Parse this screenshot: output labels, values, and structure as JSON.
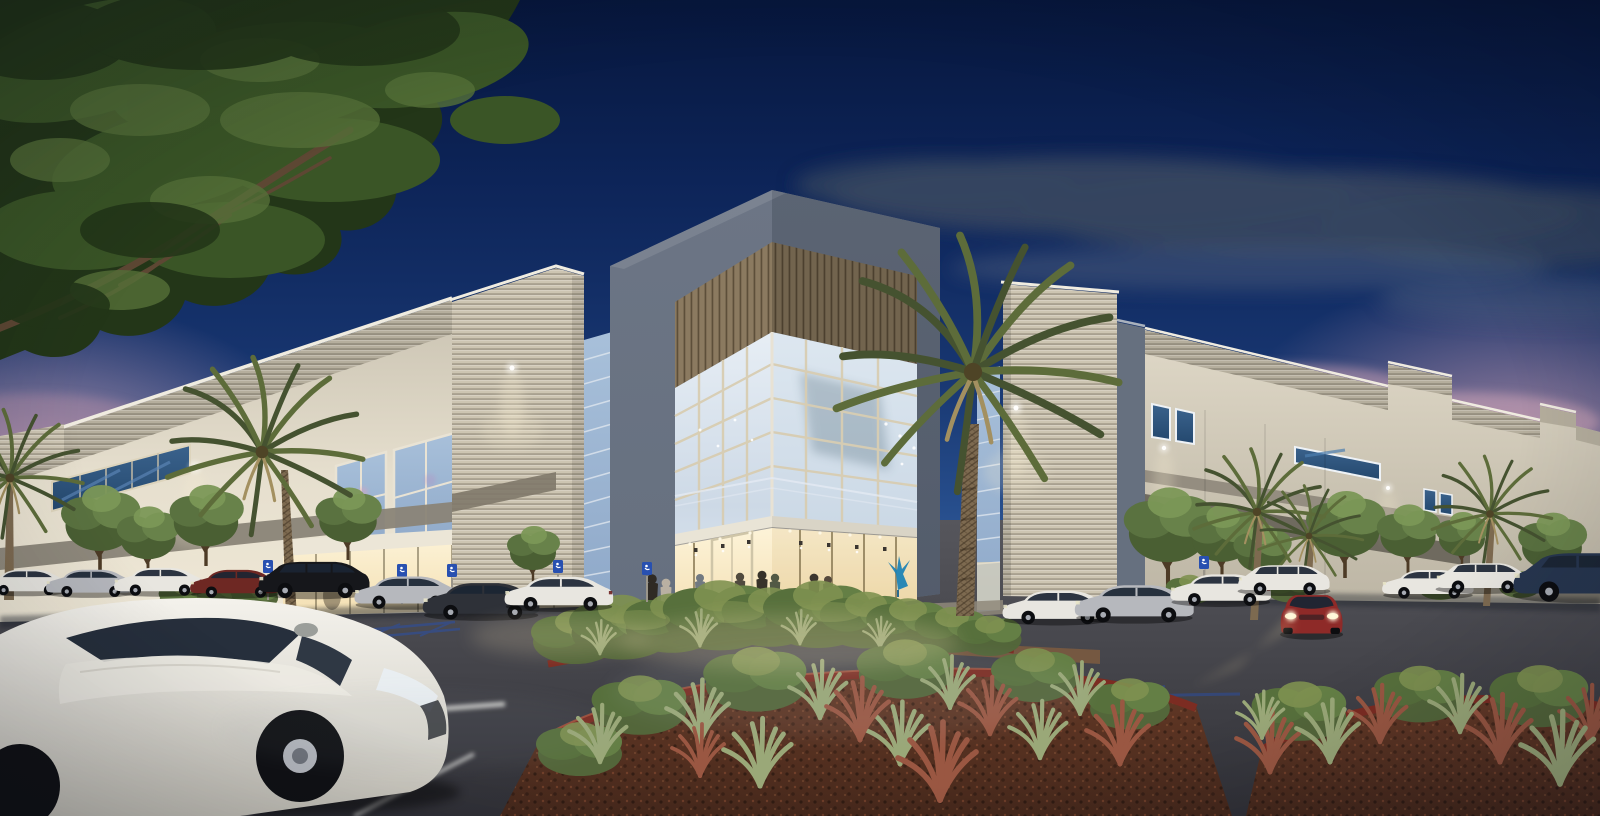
{
  "meta": {
    "kind": "architectural-rendering",
    "description": "Dusk rendering of a two-story tilt-up industrial office building with a corner glass entrance lobby, wood-slat soffit, palm trees, landscaped parking lot with cars and people",
    "width_px": 1600,
    "height_px": 816
  },
  "palette": {
    "sky_top": "#07173d",
    "sky_upper": "#0d2458",
    "sky_mid": "#17356f",
    "sky_lower": "#2a5392",
    "sky_horizon": "#5d83b4",
    "dusk_pink": "#c8a0b4",
    "dusk_mauve": "#b18ba3",
    "cloud_slate": "#36465f",
    "cloud_soft": "#51627e",
    "canopy_dark": "#233618",
    "canopy_mid": "#3a5526",
    "canopy_light": "#557038",
    "branch_brown": "#5d4733",
    "wall_cream": "#e6dfce",
    "wall_cream_dark": "#c9c2b1",
    "wall_shadow": "#aaa392",
    "rib_base": "#b5ae9d",
    "rib_tower": "#cdc5b2",
    "frame_blue": "#66707f",
    "frame_blue_dark": "#525b6a",
    "wood_slat": "#8b7a60",
    "glass_pale": "#e7eef5",
    "glass_mid": "#cdd9e6",
    "glass_blue": "#8fa9c9",
    "glass_deep": "#24486e",
    "mullion_tan": "#d8cdb2",
    "canopy_white": "#e9e4d6",
    "lobby_warm_hi": "#fdf3d8",
    "lobby_warm_lo": "#f3dfb2",
    "accent_gray": "#8a8477",
    "accent_dark": "#6f6a5f",
    "asphalt_hi": "#56565c",
    "asphalt_lo": "#313137",
    "stripe_white": "#e3e3df",
    "curb_red": "#7c2c22",
    "mulch_dark": "#46281b",
    "mulch_lit": "#663a27",
    "shrub_green": "#53663a",
    "shrub_light": "#7e9150",
    "grass_sage": "#9aa878",
    "plant_rust": "#9a5742",
    "palm_frond": "#5d6c3a",
    "palm_frond_dark": "#455230",
    "palm_trunk": "#7d6a50",
    "people_dark": "#3a332b",
    "sculpture_blue": "#1f83b5",
    "sign_blue": "#2850b0",
    "car_white": "#e8e6e0",
    "car_silver": "#b6b8bd",
    "car_dark": "#2e3138",
    "car_black": "#16171b",
    "car_red": "#8e2a28",
    "car_maroon": "#6e2823",
    "car_blue_dk": "#27364f",
    "window_tint": "#1b2533",
    "headlight_warm": "#ffe9b0"
  },
  "scene": {
    "time_of_day": "dusk",
    "sky": [
      "deep blue gradient",
      "dark slate cloud band upper right",
      "pink horizon clouds left and right"
    ],
    "building": {
      "stories": 2,
      "entrance": {
        "type": "corner glass curtain wall tower",
        "frame": "blue-gray",
        "soffit": "wood slats",
        "canopy": "white",
        "lobby_lit": true,
        "interior_art": "blue bird sculpture"
      },
      "facade_features": [
        "warm white tilt-up panels",
        "ribbed louver parapet bands",
        "dark blue ribbon windows",
        "gray accent stripes",
        "wall pack lights"
      ]
    },
    "vegetation": {
      "palms": 7,
      "ornamental_trees": 12,
      "shrub_beds": 4,
      "overhanging_tree": "top-left corner"
    },
    "vehicles": {
      "parked": 15,
      "moving": [
        "white sedan in foreground",
        "red sedan with headlights on right"
      ]
    },
    "people": 8,
    "parking": {
      "stall_stripes": "white",
      "accessible_markings": "blue",
      "accessible_signs": 6,
      "curbs": "red painted"
    }
  }
}
